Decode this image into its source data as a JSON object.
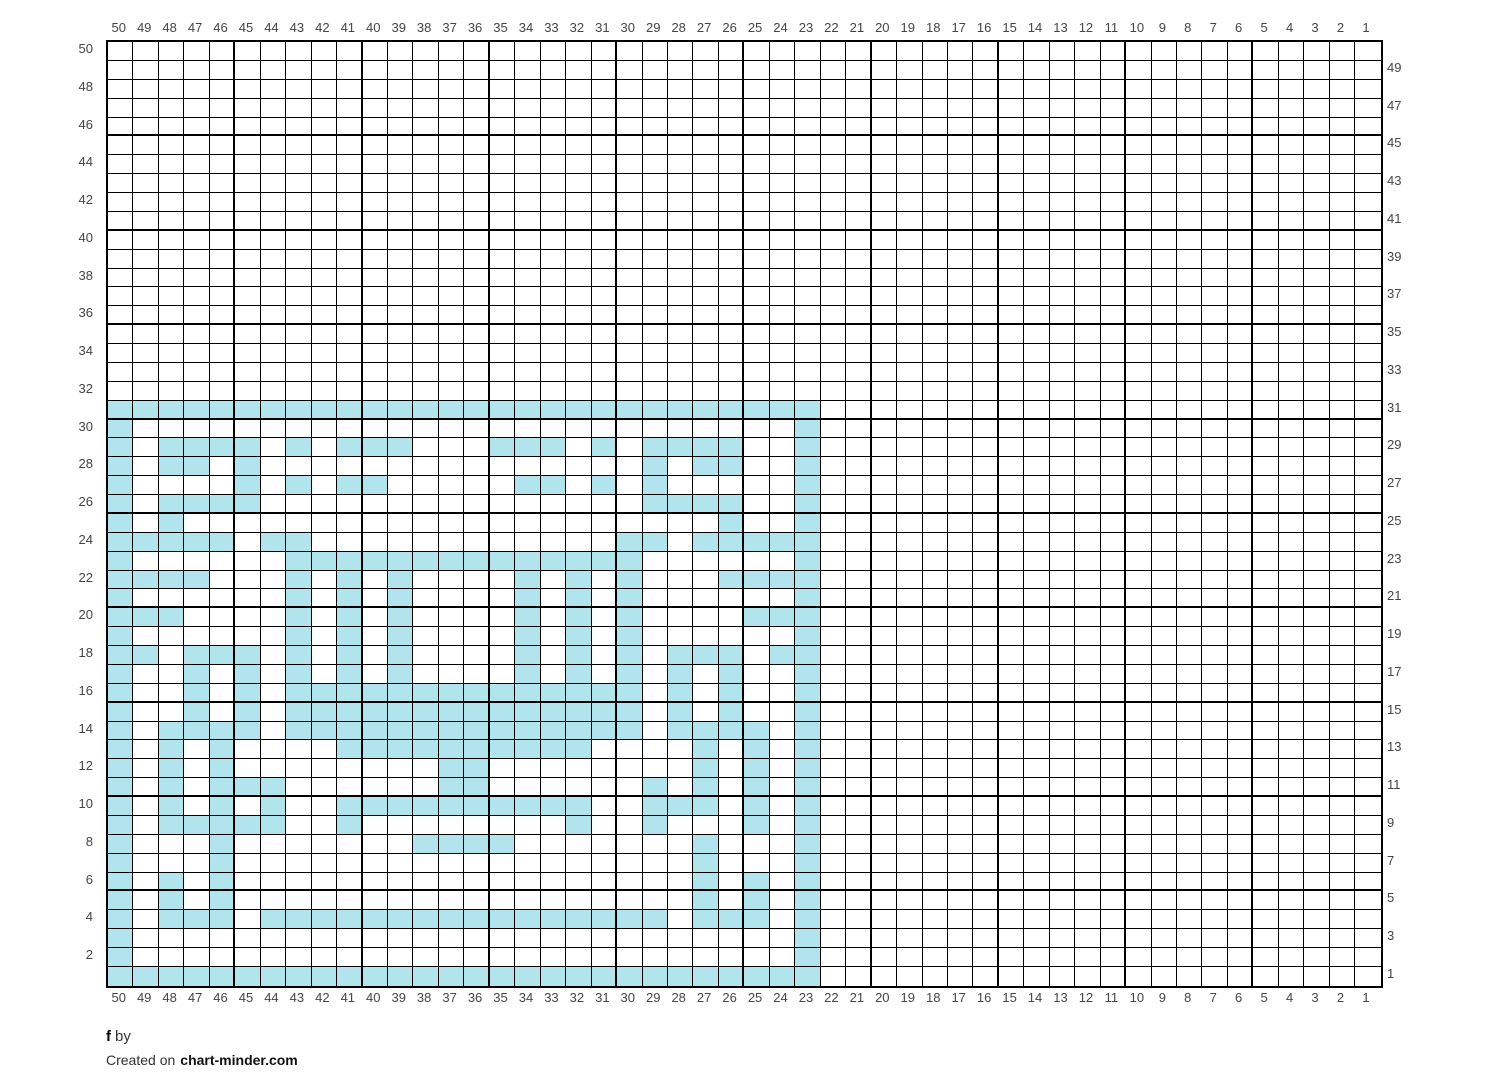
{
  "footer": {
    "title_bold": "f",
    "title_rest": "by",
    "created_prefix": "Created on",
    "site": "chart-minder.com"
  },
  "axis": {
    "top": [
      50,
      49,
      48,
      47,
      46,
      45,
      44,
      43,
      42,
      41,
      40,
      39,
      38,
      37,
      36,
      35,
      34,
      33,
      32,
      31,
      30,
      29,
      28,
      27,
      26,
      25,
      24,
      23,
      22,
      21,
      20,
      19,
      18,
      17,
      16,
      15,
      14,
      13,
      12,
      11,
      10,
      9,
      8,
      7,
      6,
      5,
      4,
      3,
      2,
      1
    ],
    "bottom": [
      50,
      49,
      48,
      47,
      46,
      45,
      44,
      43,
      42,
      41,
      40,
      39,
      38,
      37,
      36,
      35,
      34,
      33,
      32,
      31,
      30,
      29,
      28,
      27,
      26,
      25,
      24,
      23,
      22,
      21,
      20,
      19,
      18,
      17,
      16,
      15,
      14,
      13,
      12,
      11,
      10,
      9,
      8,
      7,
      6,
      5,
      4,
      3,
      2,
      1
    ],
    "left": [
      50,
      48,
      46,
      44,
      42,
      40,
      38,
      36,
      34,
      32,
      30,
      28,
      26,
      24,
      22,
      20,
      18,
      16,
      14,
      12,
      10,
      8,
      6,
      4,
      2
    ],
    "right": [
      49,
      47,
      45,
      43,
      41,
      39,
      37,
      35,
      33,
      31,
      29,
      27,
      25,
      23,
      21,
      19,
      17,
      15,
      13,
      11,
      9,
      7,
      5,
      3,
      1
    ]
  },
  "chart_data": {
    "type": "heatmap",
    "title": "f",
    "grid": {
      "cols": 50,
      "rows": 50,
      "bold_line_every": 5,
      "column_numbering": "50 at left to 1 at right",
      "row_numbering": "50 at top to 1 at bottom; even row numbers labeled on left, odd on right"
    },
    "colors": {
      "fill": "#b2e4ee",
      "empty": "#ffffff",
      "line": "#000000",
      "label": "#454545"
    },
    "encoding": "Each string is one chart row (top row = row 50, last = row 1); characters left to right are stitch columns 50 down to 1; X = filled stitch, . = empty",
    "rows_top_to_bottom": [
      "..................................................",
      "..................................................",
      "..................................................",
      "..................................................",
      "..................................................",
      "..................................................",
      "..................................................",
      "..................................................",
      "..................................................",
      "..................................................",
      "..................................................",
      "..................................................",
      "..................................................",
      "..................................................",
      "..................................................",
      "..................................................",
      "..................................................",
      "..................................................",
      "..................................................",
      "XXXXXXXXXXXXXXXXXXXXXXXXXXXX......................",
      "X..........................X......................",
      "X.XXXX.X.XXX...XXX.X.XXXX..X......................",
      "X.XX.X...............X.XX..X......................",
      "X....X.X.XX.....XX.X.X.....X......................",
      "X.XXXX...............XXXX..X......................",
      "X.X.....................X..X......................",
      "XXXXX.XX............XX.XXXXX......................",
      "X......XXXXXXXXXXXXXX......X......................",
      "XXXX...X.X.X....X.X.X...XXXX......................",
      "X......X.X.X....X.X.X......X......................",
      "XXX....X.X.X....X.X.X....XXX......................",
      "X......X.X.X....X.X.X......X......................",
      "XX.XXX.X.X.X....X.X.X.XXX.XX......................",
      "X..X.X.X.X.X....X.X.X.X.X..X......................",
      "X..X.X.XXXXXXXXXXXXXX.X.X..X......................",
      "X..X.X.XXXXXXXXXXXXXX.X.X..X......................",
      "X.XXXX.XXXXXXXXXXXXXX.XXXX.X......................",
      "X.X.X....XXXXXXXXXX....X.X.X......................",
      "X.X.X........XX........X.X.X......................",
      "X.X.XXX......XX......X.X.X.X......................",
      "X.X.X.X..XXXXXXXXXX..XXX.X.X......................",
      "X.XXXXX..X........X..X...X.X......................",
      "X...X.......XXXX.......X...X......................",
      "X...X..................X...X......................",
      "X.X.X..................X.X.X......................",
      "X.X.X..................X.X.X......................",
      "X.XXX.XXXXXXXXXXXXXXXX.XXX.X......................",
      "X..........................X......................",
      "X..........................X......................",
      "XXXXXXXXXXXXXXXXXXXXXXXXXXXX......................"
    ]
  }
}
